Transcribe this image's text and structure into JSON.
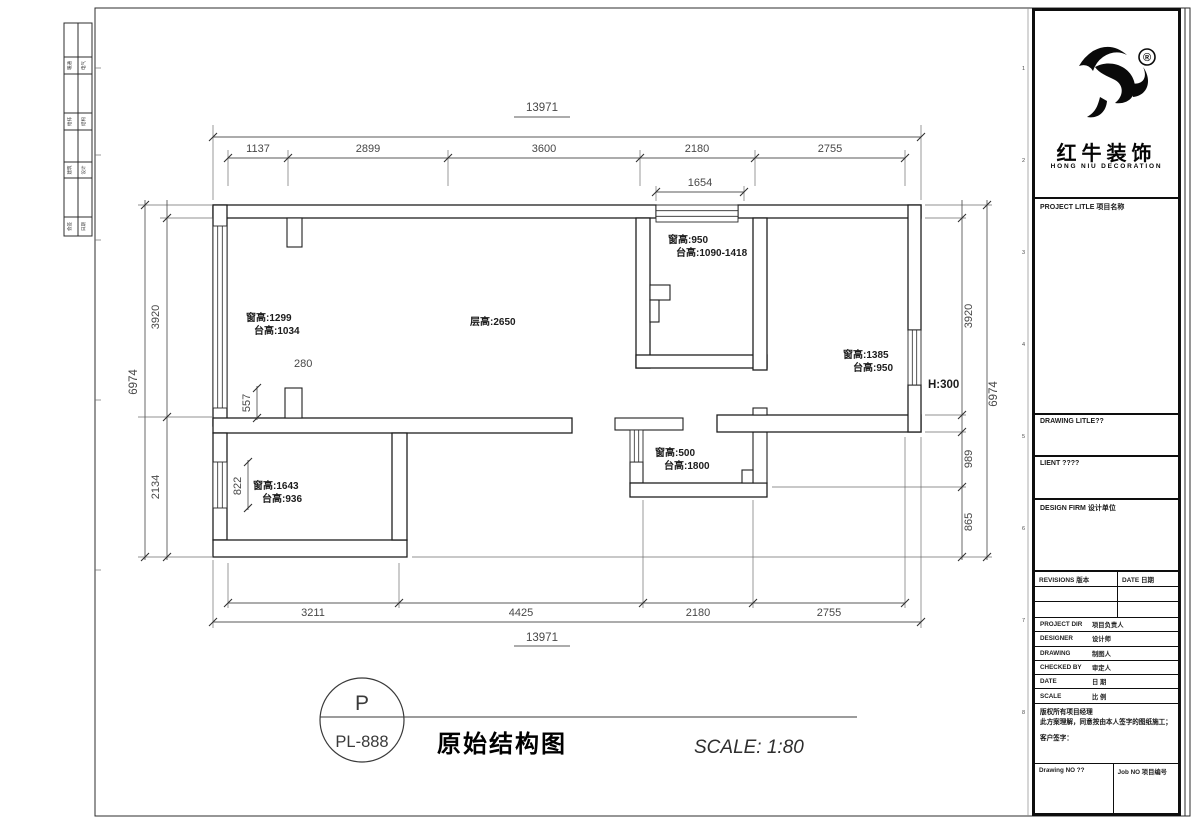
{
  "sheet": {
    "edge_numbers": [
      "1",
      "2",
      "3",
      "4",
      "5",
      "6",
      "7",
      "8"
    ]
  },
  "side_strip": {
    "rows": [
      {
        "l": "暖通",
        "r": "电气"
      },
      {
        "l": "给排",
        "r": "结构"
      },
      {
        "l": "建筑",
        "r": "设计"
      },
      {
        "l": "会签",
        "r": "日期"
      }
    ]
  },
  "plan": {
    "dims": {
      "top_overall": "13971",
      "top_segments": [
        "1137",
        "2899",
        "3600",
        "2180",
        "2755"
      ],
      "top_sub": "1654",
      "bottom_segments": [
        "3211",
        "4425",
        "2180",
        "2755"
      ],
      "bottom_overall": "13971",
      "left_inner": [
        "3920",
        "2134"
      ],
      "left_outer": "6974",
      "right_inner": [
        "3920",
        "989",
        "865"
      ],
      "right_outer": "6974",
      "interior": {
        "stub_width": "280",
        "upper": "557",
        "lower": "822"
      }
    },
    "annotations": {
      "a1": [
        "窗高:1299",
        "台高:1034"
      ],
      "a2": [
        "层高:2650"
      ],
      "a3": [
        "窗高:950",
        "台高:1090-1418"
      ],
      "a4": [
        "窗高:1385",
        "台高:950"
      ],
      "a5": [
        "H:300"
      ],
      "a6": [
        "窗高:500",
        "台高:1800"
      ],
      "a7": [
        "窗高:1643",
        "台高:936"
      ]
    }
  },
  "footer": {
    "mark_top": "P",
    "mark_code": "PL-888",
    "drawing_title": "原始结构图",
    "scale": "SCALE: 1:80"
  },
  "title_block": {
    "reg_mark": "®",
    "brand_cn": "红牛装饰",
    "brand_en": "HONG NIU DECORATION",
    "project_title": "PROJECT LITLE 项目名称",
    "drawing_title": "DRAWING LITLE??",
    "client": "LIENT ????",
    "design_firm": "DESIGN FIRM 设计单位",
    "revisions": "REVISIONS 版本",
    "rev_date": "DATE 日期",
    "rows": [
      {
        "en": "PROJECT DIR",
        "cn": "项目负责人"
      },
      {
        "en": "DESIGNER",
        "cn": "设计师"
      },
      {
        "en": "DRAWING",
        "cn": "制图人"
      },
      {
        "en": "CHECKED BY",
        "cn": "审定人"
      },
      {
        "en": "DATE",
        "cn": "日 期"
      },
      {
        "en": "SCALE",
        "cn": "比 例"
      }
    ],
    "copyright_1": "版权所有项目经理",
    "copyright_2": "此方案理解，同意按由本人签字的图纸施工；",
    "signature": "客户签字：",
    "drawing_no": "Drawing NO ??",
    "job_no": "Job NO 项目编号"
  }
}
